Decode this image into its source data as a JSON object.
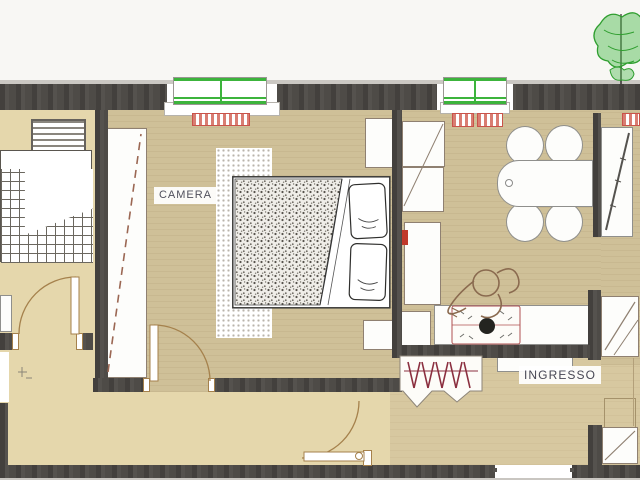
{
  "plan": {
    "type": "apartment-floor-plan",
    "labels": {
      "camera": "CAMERA",
      "ingresso": "INGRESSO"
    },
    "palette": {
      "wall": "#4e4b47",
      "floor_light": "#e5d7ac",
      "floor_mid": "#cfc098",
      "floor_entry": "#d7c8a0",
      "window_green": "#3cb43c",
      "radiator_red": "#c9534a",
      "door_brown": "#a5814c",
      "coat_hatch_red": "#8b2f3f",
      "outside": "#f8f7f4"
    }
  }
}
